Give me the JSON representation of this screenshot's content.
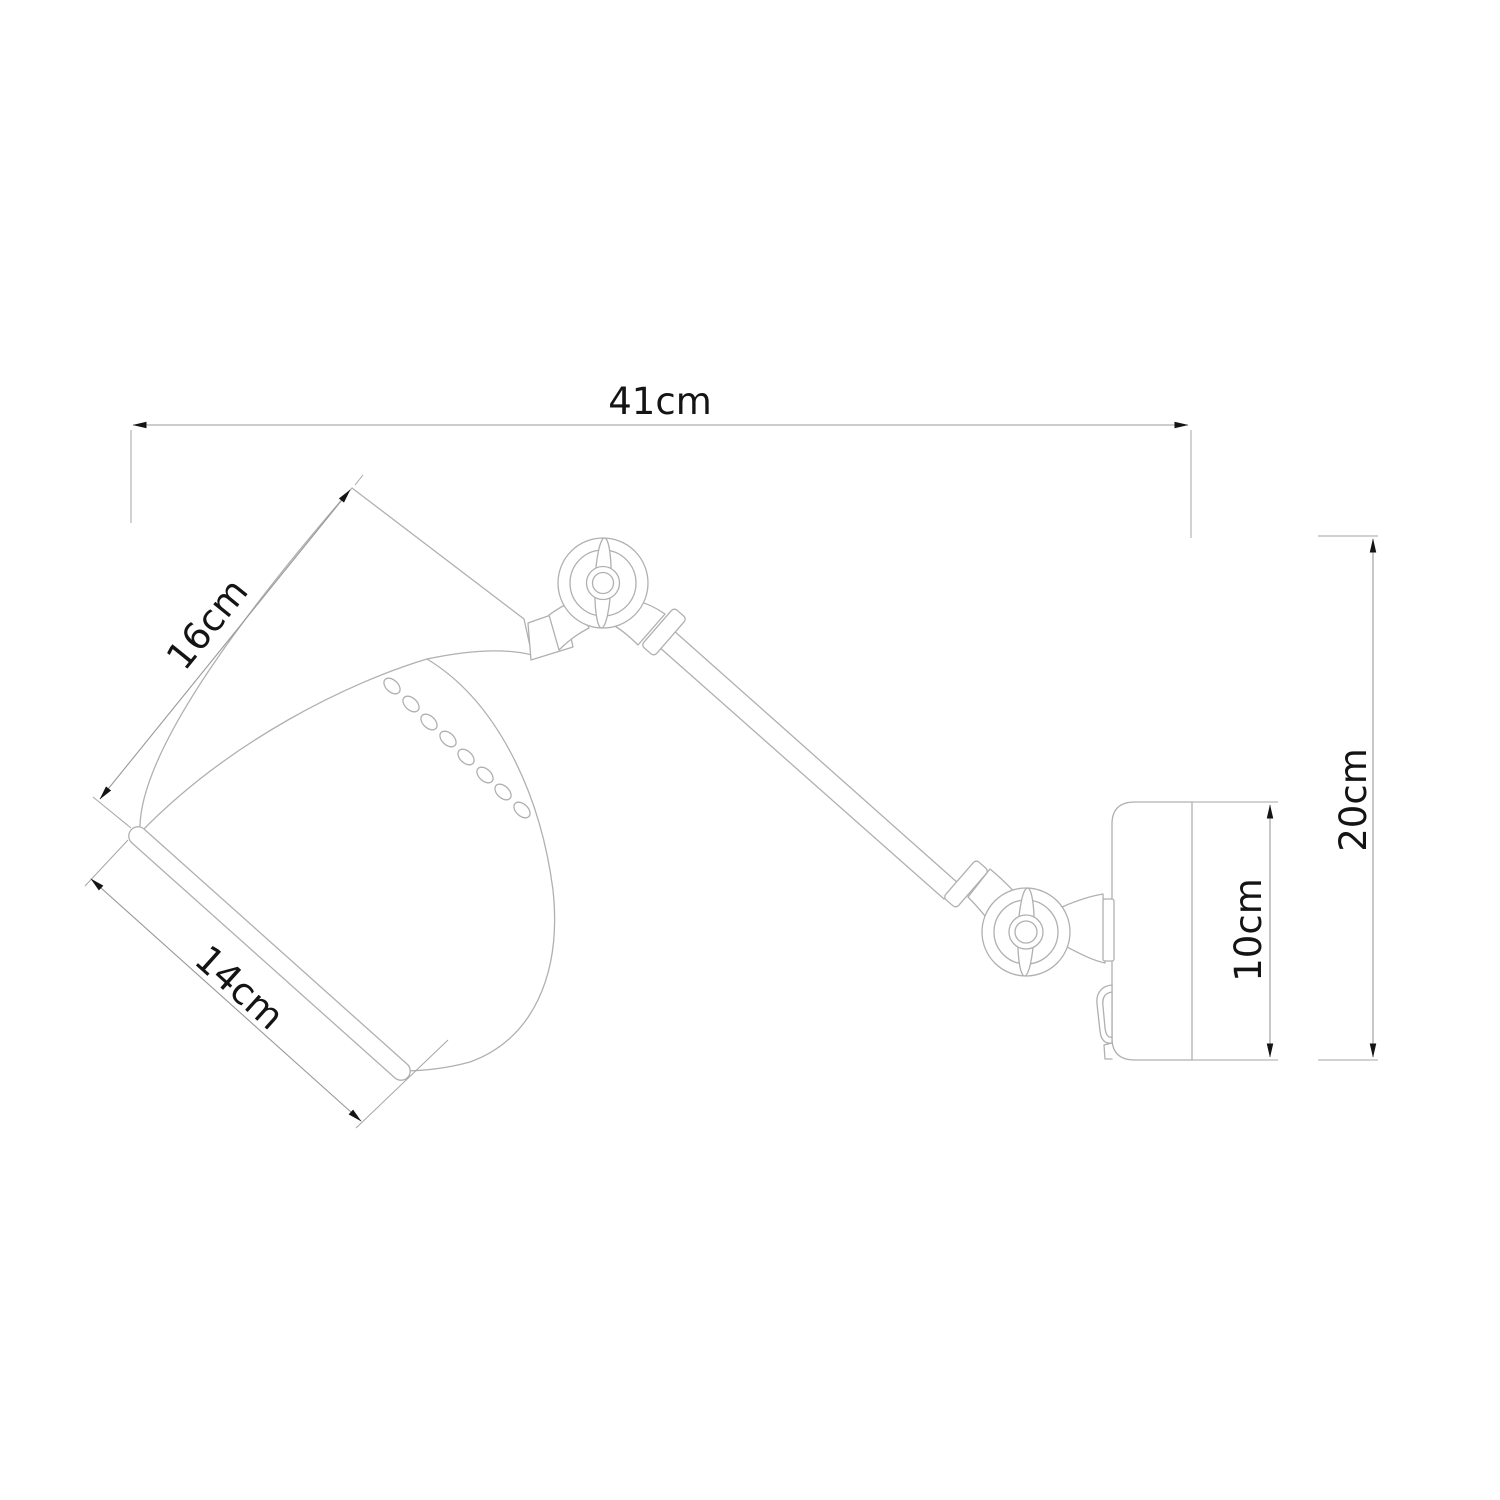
{
  "canvas": {
    "width": 1500,
    "height": 1500,
    "background": "#ffffff"
  },
  "drawing": {
    "subject": "wall-lamp-dimension-drawing",
    "line_color": "#b0b0b0",
    "dimension_line_color": "#999999",
    "arrow_color": "#141414",
    "label_color": "#141414",
    "dimensions": [
      {
        "id": "overall-width",
        "label": "41cm"
      },
      {
        "id": "shade-length",
        "label": "16cm"
      },
      {
        "id": "shade-diameter",
        "label": "14cm"
      },
      {
        "id": "mount-height",
        "label": "10cm"
      },
      {
        "id": "overall-height",
        "label": "20cm"
      }
    ],
    "parts": [
      "shade",
      "shade-rim",
      "perforations",
      "swivel-joint-top",
      "arm",
      "swivel-joint-bottom",
      "wall-mount",
      "switch"
    ]
  }
}
